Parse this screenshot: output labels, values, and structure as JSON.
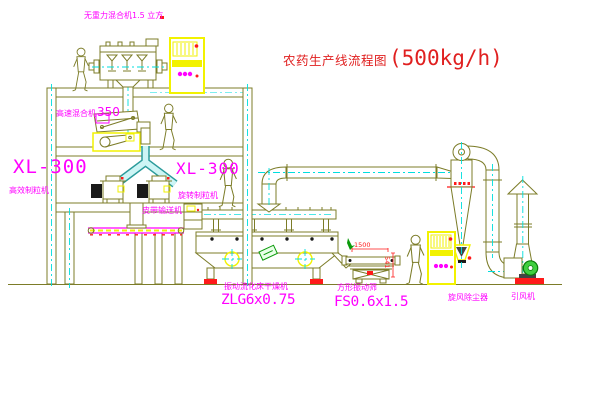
{
  "title": {
    "name": "农药生产线流程图",
    "capacity": "(500kg/h)"
  },
  "labels": {
    "gravity_mixer": "无重力混合机1.5 立方",
    "high_speed_mixer_name": "高速混合机",
    "high_speed_mixer_model": "350",
    "granulator_left_model": "XL-300",
    "granulator_left_name": "高效制粒机",
    "granulator_mid_model": "XL-300",
    "granulator_mid_name": "旋转制粒机",
    "belt_conveyor": "皮带输送机",
    "dryer_name": "振动流化床干燥机",
    "dryer_model": "ZLG6x0.75",
    "screen_name": "方形振动筛",
    "screen_model": "FS0.6x1.5",
    "cyclone_name": "旋风除尘器",
    "fan_name": "引风机"
  },
  "dimensions": {
    "screen_length": "1500",
    "screen_height": "541"
  },
  "colors": {
    "line_olive": "#7c7c28",
    "centerline_cyan": "#00dede",
    "label_magenta": "#ff00ff",
    "title_red": "#e02020",
    "cabinet_yellow": "#f2f200",
    "base_red": "#ff1a1a",
    "motor_green": "#3fcf3f",
    "background": "#ffffff"
  }
}
